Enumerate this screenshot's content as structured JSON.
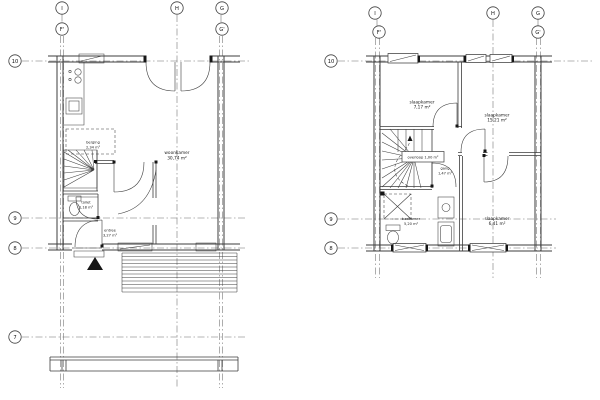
{
  "gf": {
    "bubbles": {
      "i": "I",
      "h": "H",
      "g": "G",
      "f2": "F'",
      "g2": "G'",
      "r10": "10",
      "r9": "9",
      "r8": "8",
      "r7": "7"
    },
    "rooms": {
      "woonkamer": {
        "name": "woonkamer",
        "area": "30,74 m²"
      },
      "berging": {
        "name": "berging",
        "area": "2,34 m²"
      },
      "toilet": {
        "name": "toilet",
        "area": "1,18 m²"
      },
      "entree": {
        "name": "entree",
        "area": "3,27 m²"
      }
    }
  },
  "ff": {
    "bubbles": {
      "i": "I",
      "h": "H",
      "g": "G",
      "f2": "F'",
      "g2": "G'",
      "r10": "10",
      "r9": "9",
      "r8": "8"
    },
    "rooms": {
      "slaapkamer1": {
        "name": "slaapkamer",
        "area": "7,17 m²"
      },
      "slaapkamer2": {
        "name": "slaapkamer",
        "area": "15,21 m²"
      },
      "slaapkamer3": {
        "name": "slaapkamer",
        "area": "6,41 m²"
      },
      "badkamer": {
        "name": "badkamer",
        "area": "5,20 m²"
      },
      "gang": {
        "name": "gang",
        "area": "1,47 m²"
      },
      "overloop_tag": "overloop 1,00 m²"
    }
  }
}
